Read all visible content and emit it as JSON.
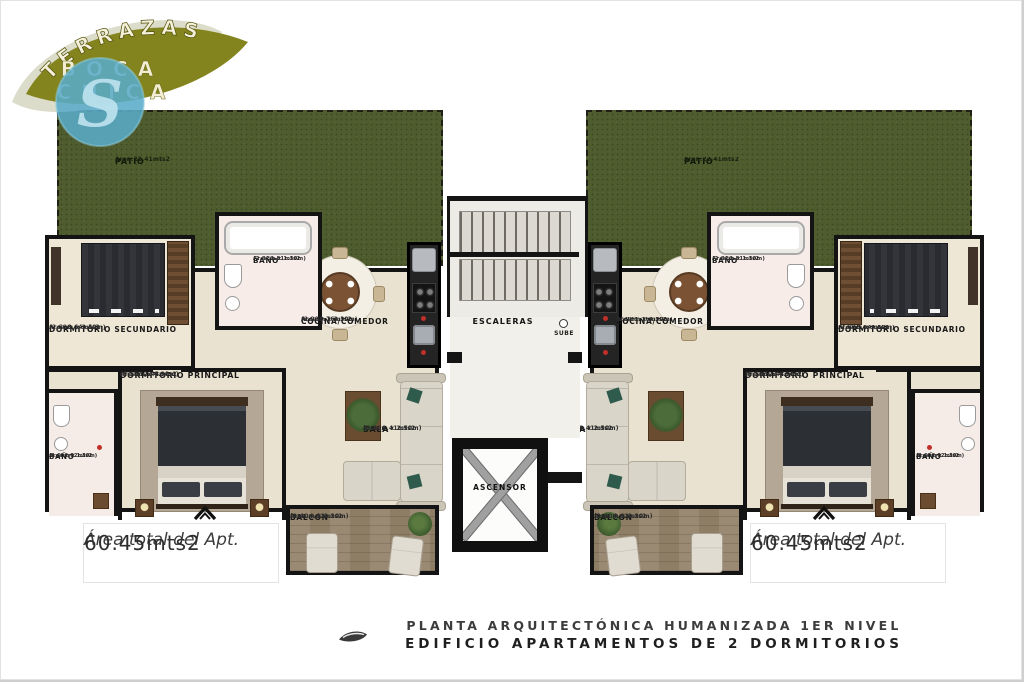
{
  "logo": {
    "arc_text": "TERRAZAS",
    "word1": "BOCA",
    "word2": "CHICA",
    "monogram": "S"
  },
  "apartments": {
    "left": {
      "patio": {
        "name": "PATIO",
        "area": "Area:22.41mts2"
      },
      "dorm_sec": {
        "name": "DORMITORIO SECUNDARIO",
        "area": "Area:8.64mts2",
        "dims": "(2.60m x 3.50m)"
      },
      "bano_top": {
        "name": "BAÑO",
        "area": "Area:2.81mts2",
        "dims": "(2.81m x 1.30m)"
      },
      "cocina": {
        "name": "COCINA/COMEDOR",
        "area": "Area:9.76mts2",
        "dims": "(2.90m x 3.30m)"
      },
      "dorm_prin": {
        "name": "DORMITORIO PRINCIPAL",
        "area": "Area:12.44mts2",
        "dims": "(3.10m x 4.90m)"
      },
      "bano_bot": {
        "name": "BAÑO",
        "area": "Area:2.02mts2",
        "dims": "(1.60m x 1.30m)"
      },
      "sala": {
        "name": "SALA",
        "area": "Area:8.41mts2",
        "dims": "(3.30m x 2.50m)"
      },
      "balcon": {
        "name": "BALCON",
        "area": "Area:4.62mts2",
        "dims": "(1.40m x 3.30m)"
      },
      "total": {
        "label": "Área total del Apt.",
        "value": "60.45mts2"
      }
    },
    "right": {
      "patio": {
        "name": "PATIO",
        "area": "Area:22.41mts2"
      },
      "dorm_sec": {
        "name": "DORMITORIO SECUNDARIO",
        "area": "Area:8.64mts2",
        "dims": "(2.60m x 3.50m)"
      },
      "bano_top": {
        "name": "BAÑO",
        "area": "Area:2.81mts2",
        "dims": "(2.81m x 1.30m)"
      },
      "cocina": {
        "name": "COCINA/COMEDOR",
        "area": "Area:1.76mts2",
        "dims": "(2.90m x 3.30m)"
      },
      "dorm_prin": {
        "name": "DORMITORIO PRINCIPAL",
        "area": "Area:12.44mts2",
        "dims": "(3.10m x 4.90m)"
      },
      "bano_bot": {
        "name": "BAÑO",
        "area": "Area:2.02mts2",
        "dims": "(1.60m x 1.30m)"
      },
      "sala": {
        "name": "SALA",
        "area": "Area:8.41mts2",
        "dims": "(3.30m x 2.50m)"
      },
      "balcon": {
        "name": "BALCON",
        "area": "Area:4.62mts2",
        "dims": "(1.40m x 3.30m)"
      },
      "total": {
        "label": "Área total del Apt.",
        "value": "60.45mts2"
      }
    }
  },
  "core": {
    "stairs_label": "ESCALERAS",
    "stairs_direction": "SUBE",
    "elevator_label": "ASCENSOR"
  },
  "caption": {
    "line1": "PLANTA ARQUITECTÓNICA HUMANIZADA 1ER NIVEL",
    "line2": "EDIFICIO APARTAMENTOS DE 2 DORMITORIOS"
  },
  "colors": {
    "brand_olive": "#84841e",
    "brand_blue": "#5aabc8",
    "patio_green": "#4e5c2e",
    "wall": "#141414",
    "floor_beige": "#eae2d0"
  }
}
